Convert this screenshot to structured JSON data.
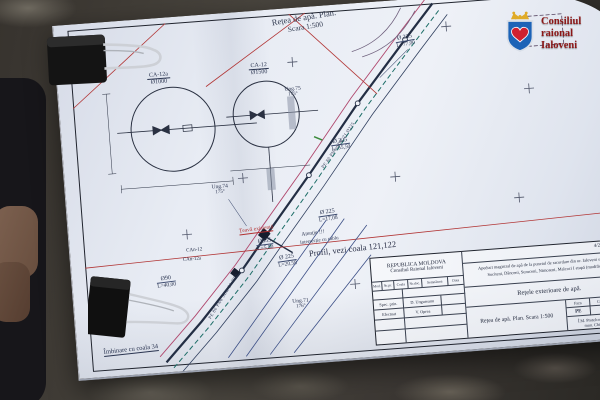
{
  "logo": {
    "line1": "Consiliul",
    "line2": "raional",
    "line3": "Ialoveni",
    "shield_color": "#1c63b7",
    "heart_color": "#cf2030",
    "crown_color": "#e0ab27"
  },
  "plan": {
    "title_line1": "Rețea de apă. Plan.",
    "title_line2": "Scara 1:500",
    "details": [
      {
        "name": "CA-12a",
        "dia": "Ø1000"
      },
      {
        "name": "CA-12",
        "dia": "Ø1500"
      }
    ],
    "pipe_labels": [
      {
        "d": "Ø 225",
        "l": "L=77,00"
      },
      {
        "d": "Ø 225",
        "l": "L=55,50"
      },
      {
        "d": "Ø 225",
        "l": "L=17,08"
      },
      {
        "d": "Ø 225",
        "l": "L=20,58"
      },
      {
        "d": "Ø355",
        "l": "L=5,50"
      },
      {
        "d": "Ø90",
        "l": "L=40,00"
      }
    ],
    "angles": [
      {
        "name": "Ung.74",
        "value": "175°"
      },
      {
        "name": "Ung.75",
        "value": "175°"
      },
      {
        "name": "Ung.71",
        "value": "176°"
      }
    ],
    "nodes": [
      "CAn-12",
      "CAn-12a"
    ],
    "existing_pipe": "Țeavă existentă",
    "attention_line1": "Atenție !!!",
    "attention_line2": "Intersecție cu cablu",
    "profile_note": "Profil, vezi coala 121,122",
    "join_note": "Îmbinare cu coala 34",
    "pipe_spec_main": "PE 80 PN6 SDR 21 Ø225",
    "pipe_spec_branch": "PE 80 PN6 SDR 21 Ø90"
  },
  "title_block": {
    "country": "REPUBLICA MOLDOVA",
    "council": "Consiliul Raional Ialoveni",
    "doc_code": "4/23.01.14 - AII",
    "project_line1": "Apeduct magistral de apă de la punctul de racordare din or. Ialoveni spre satele",
    "project_line2": "Sociteni, Dănceni, Suruceni, Nimoreni, Malcoci I etapă (modificare)",
    "sheet_title": "Rețele exterioare de apă.",
    "sheet_subtitle": "Rețea de apă. Plan. Scara 1:500",
    "col_headers": [
      "Mod.",
      "Nr.pr.",
      "Coala",
      "Nr.doc.",
      "Semnătura",
      "Data"
    ],
    "staff": [
      {
        "role": "Spec. prin.",
        "name": "D. Ungureanu"
      },
      {
        "role": "Efectuat",
        "name": "V. Oprea"
      }
    ],
    "faza_label": "Faza",
    "faza_value": "PE",
    "coala_label": "Coala",
    "coala_value": "30",
    "col_label": "Col.",
    "company_line1": "Î.M. Protelco Gecoul S.R.L.",
    "company_line2": "mun. Chișinău, 2019"
  }
}
